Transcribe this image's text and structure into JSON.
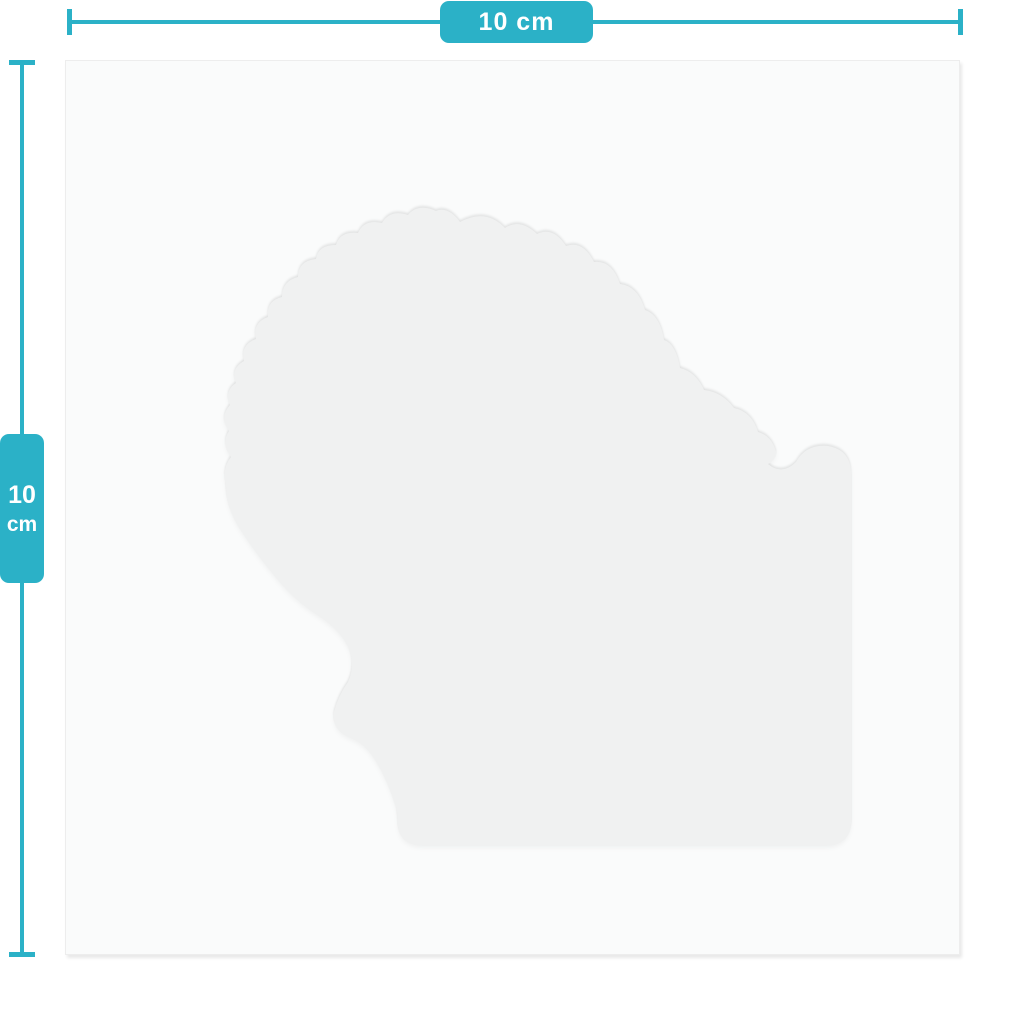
{
  "title": "Sticker sheet size guide",
  "colors": {
    "accent_teal": "#2bb1c7",
    "badge_text": "#ffffff",
    "page_bg": "#ffffff",
    "sheet_bg": "#fafbfb",
    "sheet_border": "#ededed",
    "sticker_fill": "#f0f1f1"
  },
  "horizontal_dimension": {
    "label": "10 cm",
    "value": "10",
    "unit": "cm"
  },
  "vertical_dimension": {
    "value": "10",
    "unit": "cm"
  },
  "sheet": {
    "width_cm": 10,
    "height_cm": 10
  },
  "icons": [
    "horizontal-ruler-line",
    "ruler-end-cap",
    "vertical-ruler-line",
    "die-cut-sticker-shape"
  ]
}
